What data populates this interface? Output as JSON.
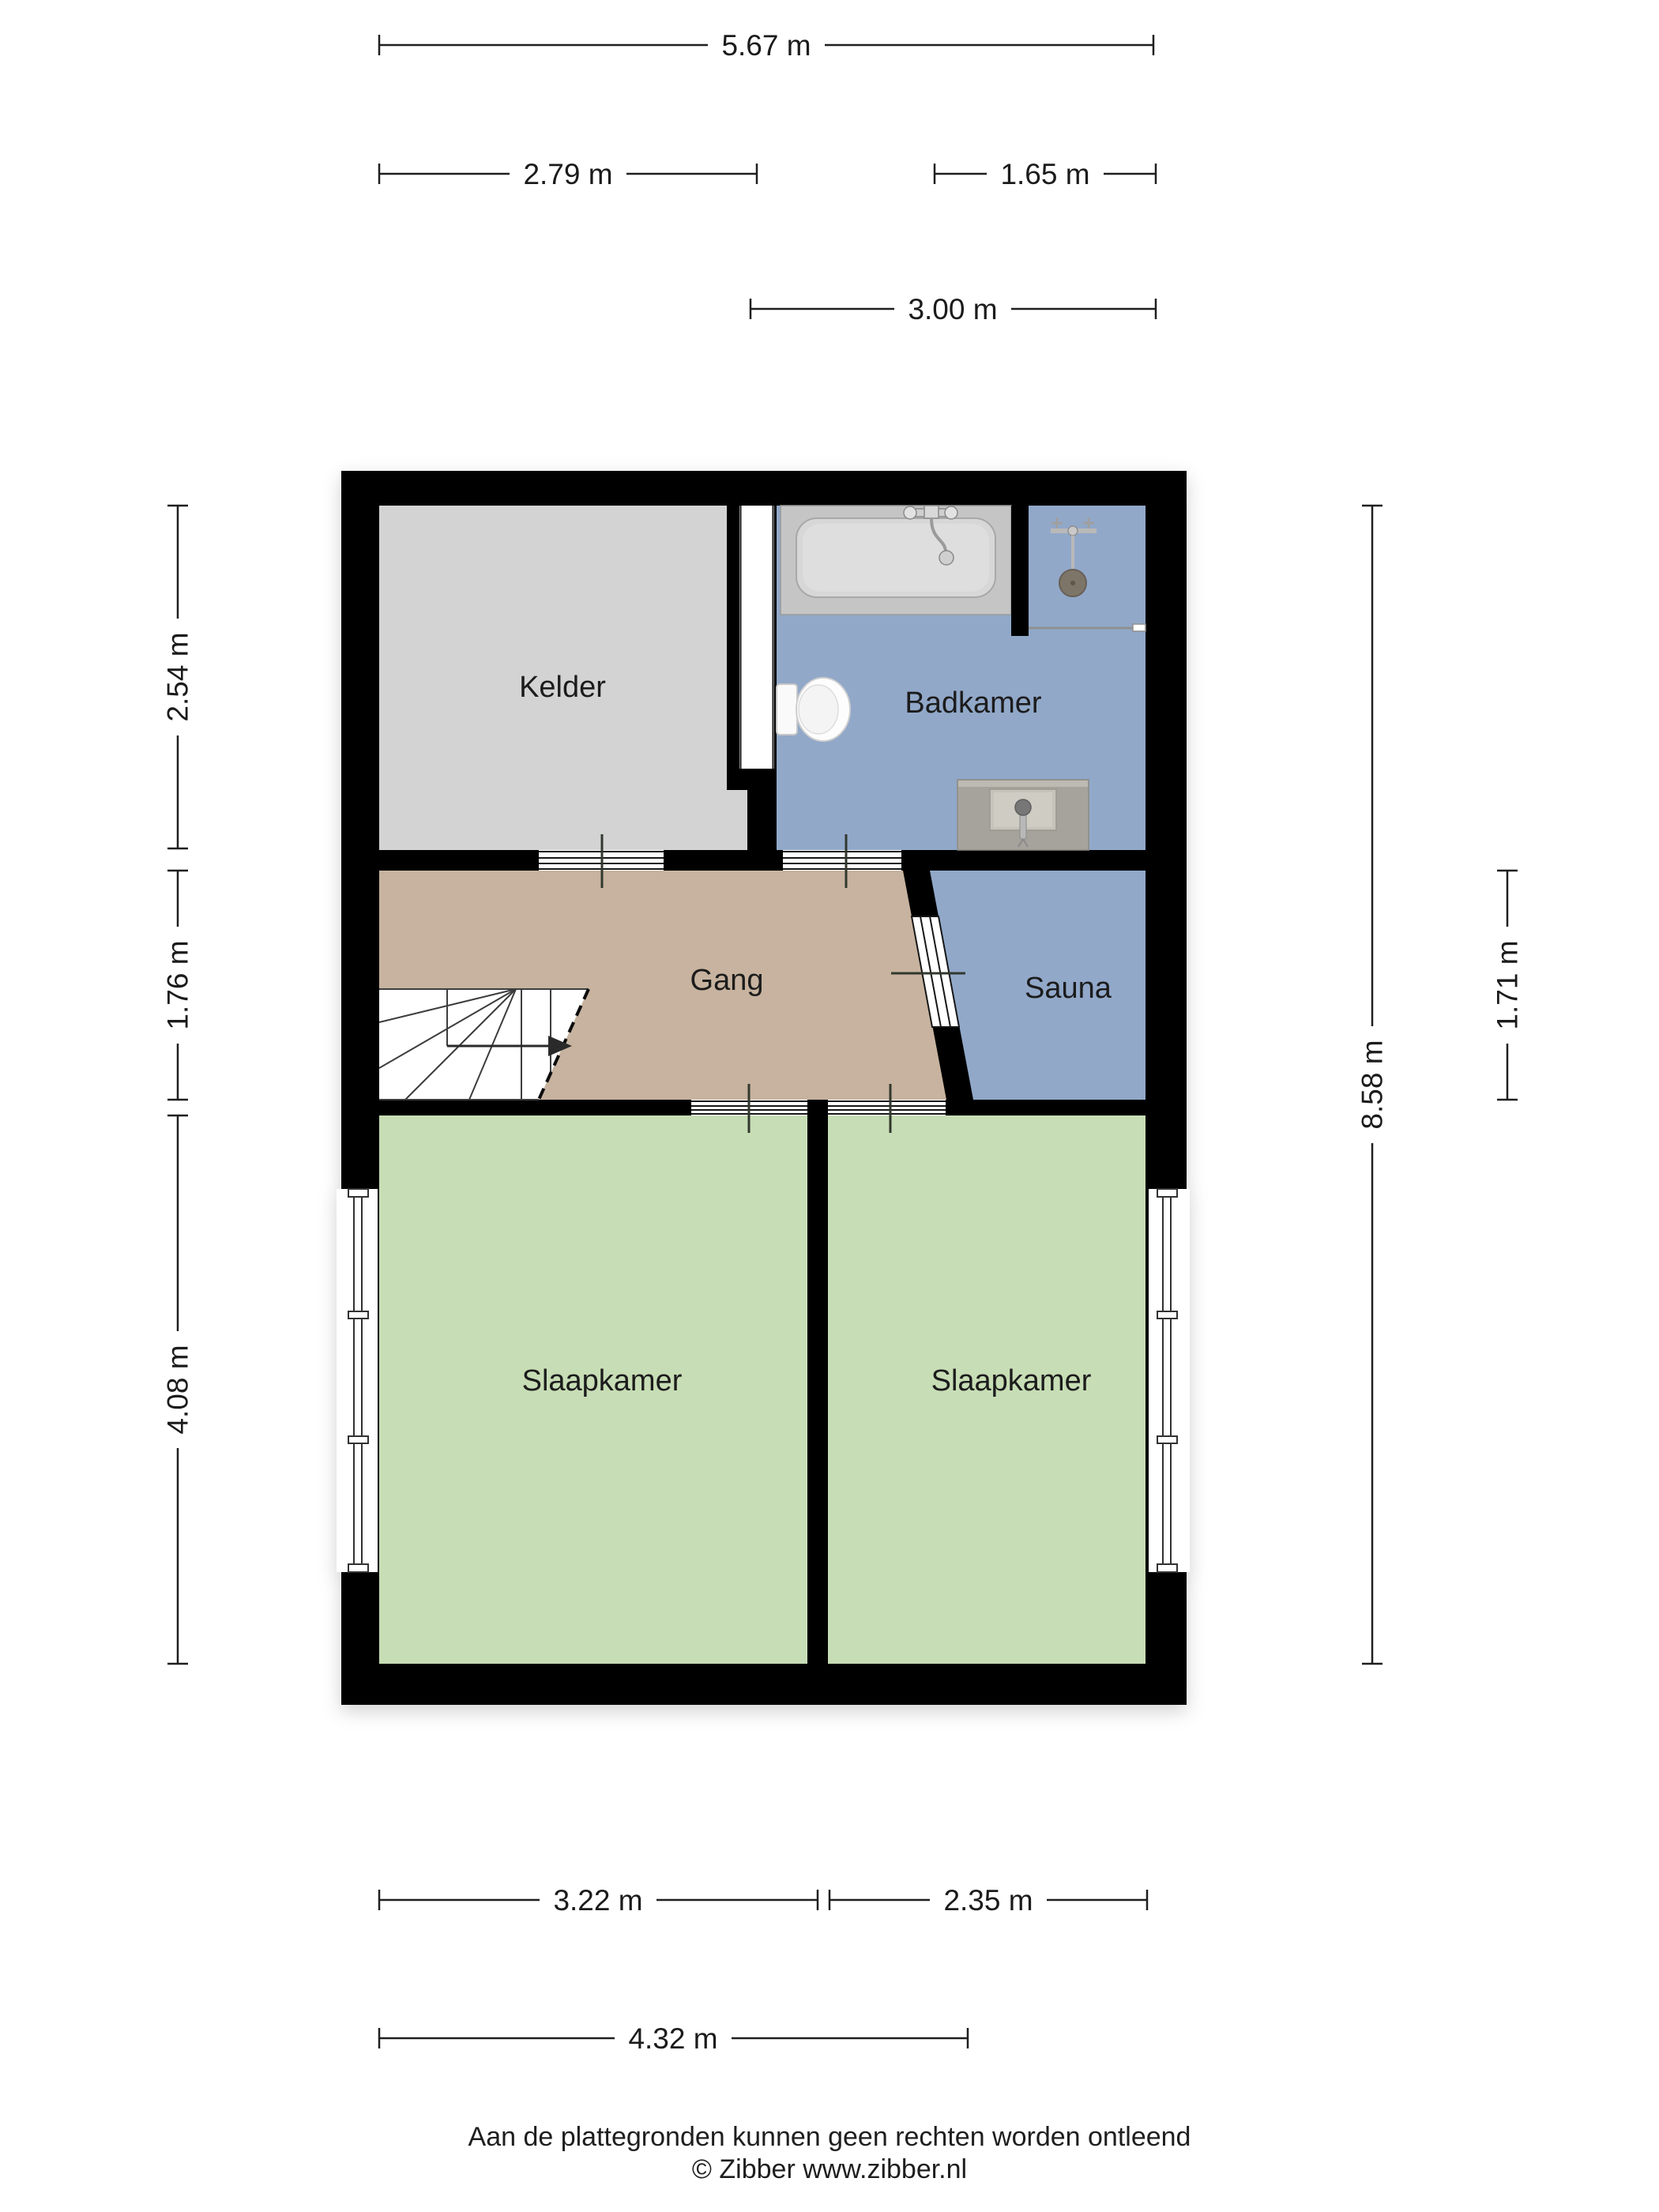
{
  "plan": {
    "rooms": [
      {
        "id": "kelder",
        "label": "Kelder"
      },
      {
        "id": "badkamer",
        "label": "Badkamer"
      },
      {
        "id": "gang",
        "label": "Gang"
      },
      {
        "id": "sauna",
        "label": "Sauna"
      },
      {
        "id": "slaapkamer-left",
        "label": "Slaapkamer"
      },
      {
        "id": "slaapkamer-right",
        "label": "Slaapkamer"
      }
    ],
    "dimensions": {
      "top_total": "5.67 m",
      "top_left": "2.79 m",
      "top_right": "1.65 m",
      "top_bathroom": "3.00 m",
      "left_cellar": "2.54 m",
      "left_hall": "1.76 m",
      "left_bedroom": "4.08 m",
      "right_total": "8.58 m",
      "right_sauna": "1.71 m",
      "bottom_bedroom_left": "3.22 m",
      "bottom_bedroom_right": "2.35 m",
      "bottom_total": "4.32 m"
    },
    "colors": {
      "wall": "#000000",
      "cellar": "#d3d3d3",
      "bathroom": "#91a8c9",
      "hall": "#c7b39f",
      "sauna": "#91a8c9",
      "bedroom": "#c7ddb5",
      "fixture_gray": "#c5c5c5",
      "sink_gray": "#a6a39c",
      "shower_head": "#7d7568"
    },
    "footer": {
      "disclaimer": "Aan de plattegronden kunnen geen rechten worden ontleend",
      "credit": "© Zibber www.zibber.nl"
    }
  }
}
